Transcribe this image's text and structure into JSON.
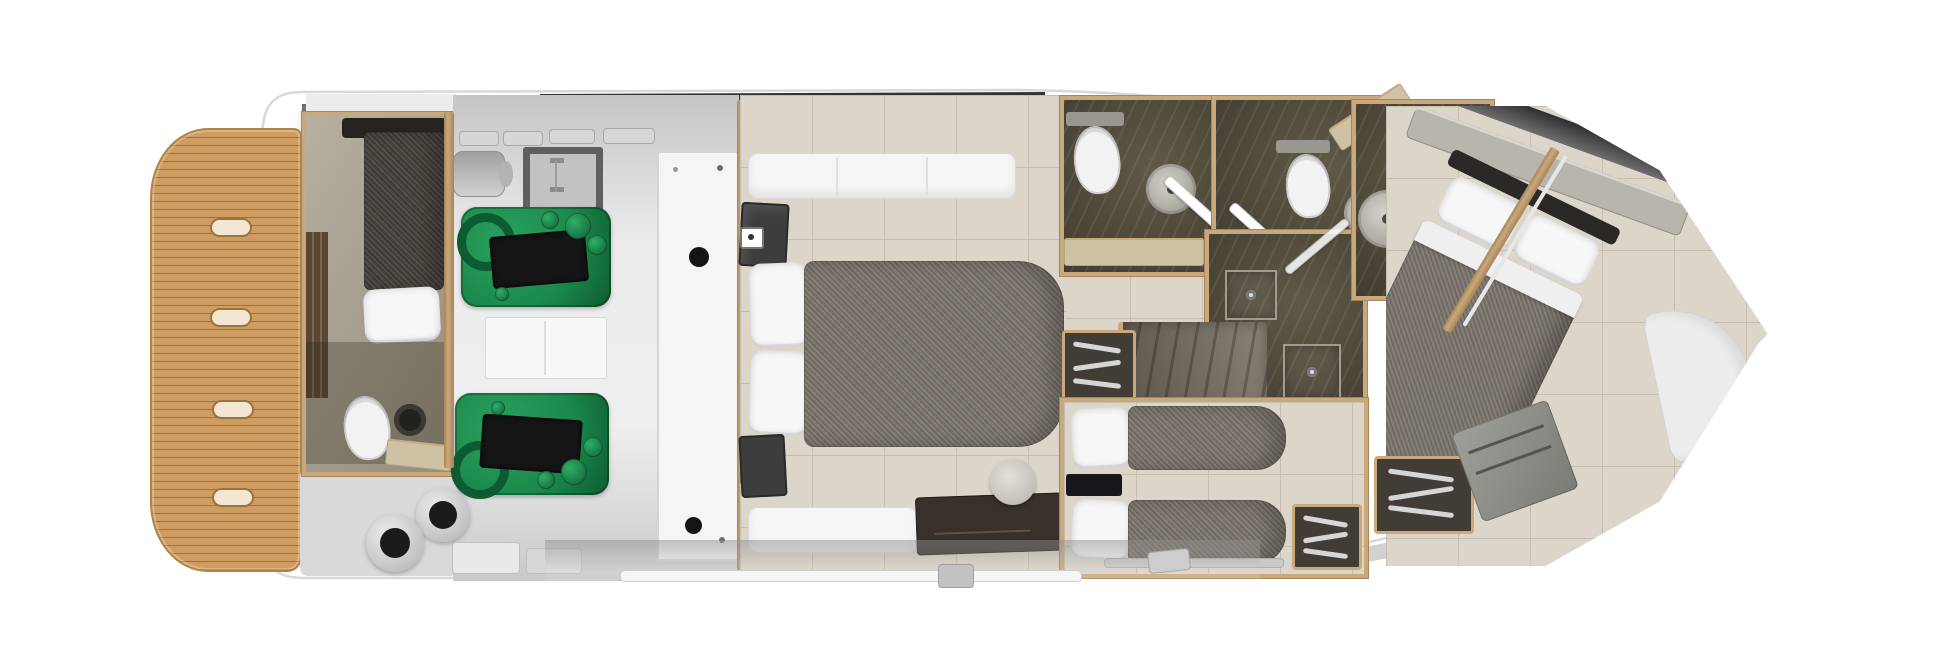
{
  "diagram": {
    "type": "yacht-lower-deck-floor-plan",
    "orientation": "bow-right-stern-left",
    "rooms": [
      {
        "id": "swim-platform",
        "material": "teak",
        "deck_hatches": 4
      },
      {
        "id": "transom-steps"
      },
      {
        "id": "crew-cabin",
        "beds": 1,
        "toilet": 1,
        "sink": 1,
        "locker": 1
      },
      {
        "id": "engine-room",
        "engines": 2,
        "fuel_filters": 2,
        "deck_hatch": 1,
        "muffler": 1,
        "tall_cabinet": 1,
        "workbench": 1
      },
      {
        "id": "master-cabin",
        "double_bed": 1,
        "pillows": 2,
        "sofas": 2,
        "tv-cabinets": 2,
        "vanity_desk": 1,
        "stool": 1
      },
      {
        "id": "master-head",
        "toilet": 1,
        "sink": 1,
        "counter": 1
      },
      {
        "id": "day-head",
        "toilet": 1,
        "sink": 1,
        "counter": 1
      },
      {
        "id": "shower-room",
        "shower_trays": 2
      },
      {
        "id": "staircase",
        "turn": "quarter"
      },
      {
        "id": "twin-cabin",
        "single_beds": 2,
        "pillows": 2,
        "wardrobes": 2,
        "nightstand": 1
      },
      {
        "id": "vip-head",
        "sink": 1,
        "vanity": 1
      },
      {
        "id": "vip-cabin",
        "double_bed_angled": 1,
        "pillows": 2,
        "wardrobe": 1,
        "locker": 1,
        "bow_seat": 1,
        "sideboard": 1
      }
    ],
    "palette": {
      "white": "#ffffff",
      "hull_line": "#d8d8d8",
      "teak": "#cf9d62",
      "teak_line": "#9a743f",
      "teak_edge": "#b08447",
      "wood": "#c9a97c",
      "wood_dark": "#a8855a",
      "gray_floor_a": "#c5c5c5",
      "gray_floor_b": "#ebebeb",
      "beige_floor": "#dbd5ca",
      "beige_line": "#c6bfb1",
      "dark_floor": "#57503e",
      "mattress": "#7c766d",
      "crew_mattress": "#46413b",
      "pillow": "#f7f7f7",
      "engine_green": "#1b8a4c",
      "engine_green_dark": "#0d5c31",
      "engine_black": "#151515",
      "furn_white": "#f5f5f5",
      "counter": "#cfc2a4",
      "cabinet_dark": "#413d36",
      "desk_brown": "#38302a",
      "band_dark": "#1d1d1d"
    }
  }
}
